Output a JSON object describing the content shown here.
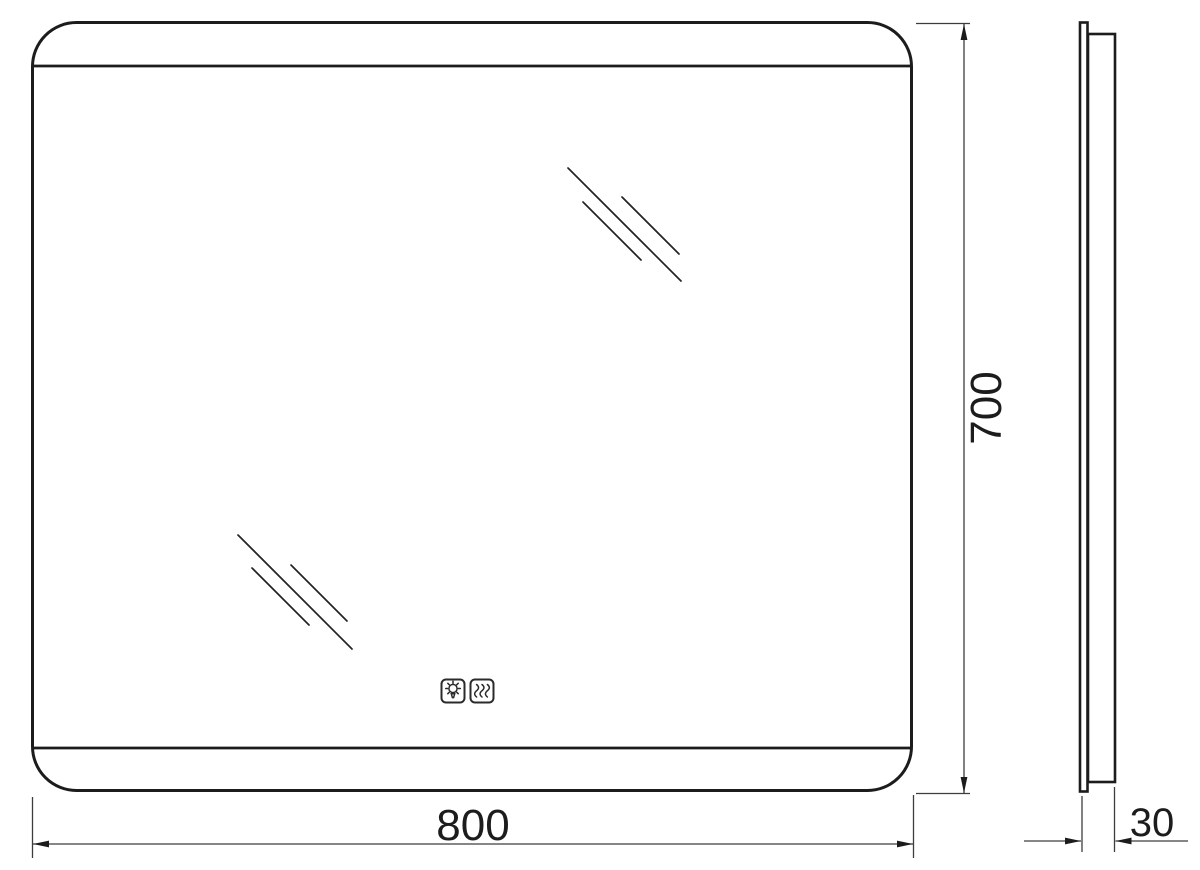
{
  "drawing": {
    "type": "technical-dimension-drawing",
    "subject": "rectangular-led-mirror",
    "views": {
      "front": {
        "width_label": "800",
        "height_label": "700"
      },
      "side": {
        "depth_label": "30"
      }
    },
    "icons": [
      {
        "name": "light-bulb-icon"
      },
      {
        "name": "heating-waves-icon"
      }
    ],
    "colors": {
      "background": "#ffffff",
      "outline": "#1c1c1c",
      "dimension_line": "#3d3d3d"
    }
  }
}
